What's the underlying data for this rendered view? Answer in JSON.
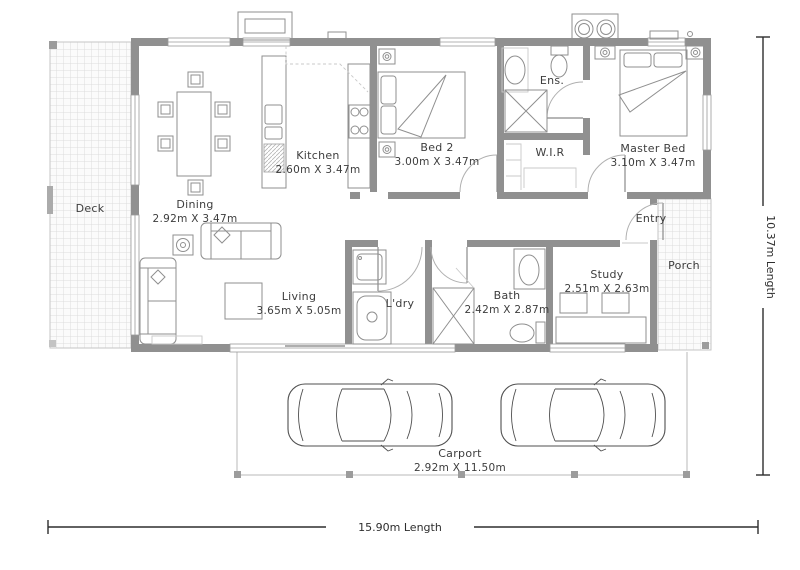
{
  "rooms": {
    "deck": {
      "name": "Deck"
    },
    "dining": {
      "name": "Dining",
      "size": "2.92m X 3.47m"
    },
    "kitchen": {
      "name": "Kitchen",
      "size": "2.60m X 3.47m"
    },
    "bed2": {
      "name": "Bed 2",
      "size": "3.00m X 3.47m"
    },
    "wir": {
      "name": "W.I.R"
    },
    "ens": {
      "name": "Ens."
    },
    "master": {
      "name": "Master Bed",
      "size": "3.10m X 3.47m"
    },
    "entry": {
      "name": "Entry"
    },
    "porch": {
      "name": "Porch"
    },
    "living": {
      "name": "Living",
      "size": "3.65m X 5.05m"
    },
    "laundry": {
      "name": "L'dry"
    },
    "bath": {
      "name": "Bath",
      "size": "2.42m X 2.87m"
    },
    "study": {
      "name": "Study",
      "size": "2.51m X 2.63m"
    },
    "carport": {
      "name": "Carport",
      "size": "2.92m X 11.50m"
    }
  },
  "dimensions": {
    "width_label": "15.90m Length",
    "height_label": "10.37m Length"
  },
  "colors": {
    "wall": "#909090",
    "furniture_line": "#8f8f8f",
    "car_line": "#4f4f4f",
    "text": "#3d3d3d",
    "hatch_line": "#dcdcdc",
    "dimension_line": "#2e2e2e"
  }
}
